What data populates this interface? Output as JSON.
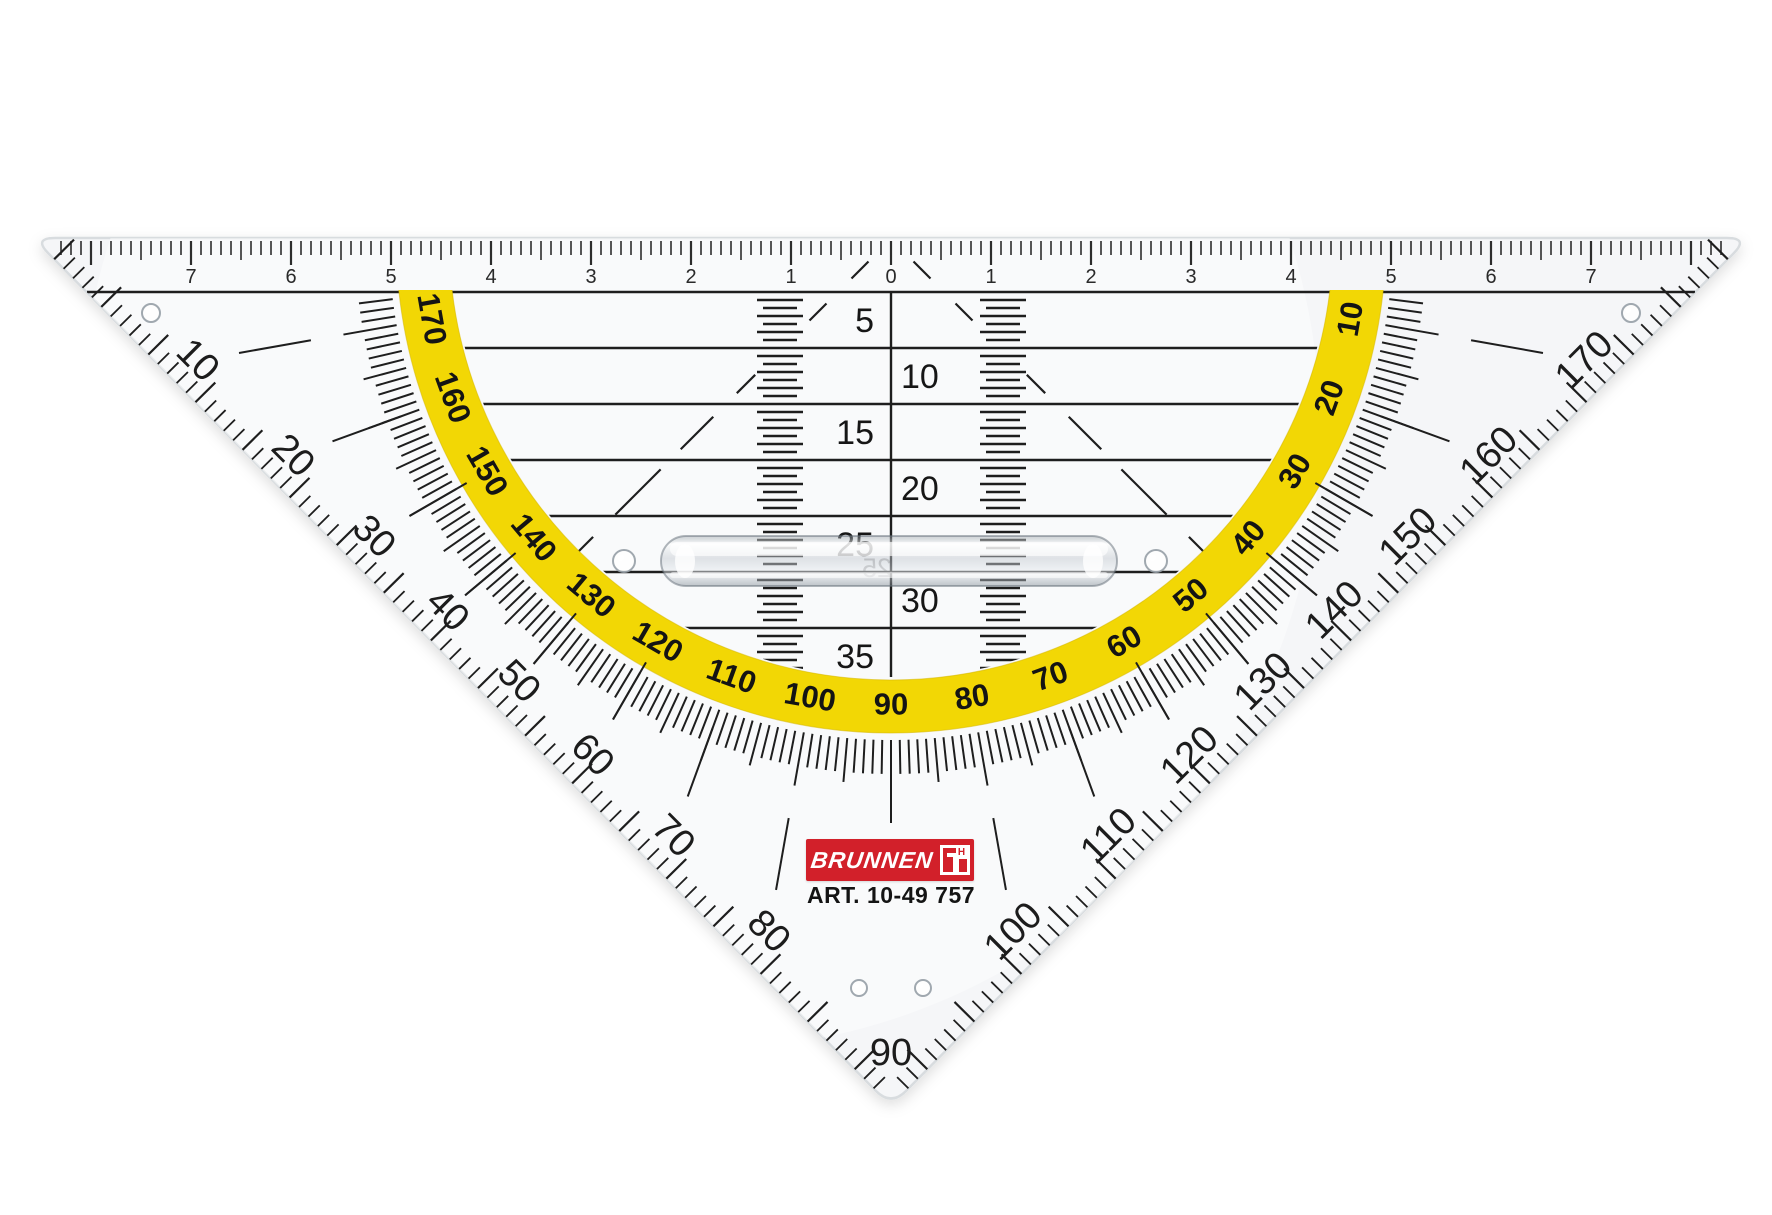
{
  "product": {
    "brand": "BRUNNEN",
    "art_number": "ART. 10-49 757",
    "logo_mark_letter": "H"
  },
  "colors": {
    "plastic": "#f5f6f8",
    "plastic_edge": "#d8dcdf",
    "ink": "#1e1e1e",
    "ink_soft": "#2d2d2d",
    "band_yellow": "#F2D705",
    "brand_red": "#d2202a",
    "white": "#ffffff"
  },
  "ruler": {
    "unit_labels": [
      "7",
      "6",
      "5",
      "4",
      "3",
      "2",
      "1",
      "0",
      "1",
      "2",
      "3",
      "4",
      "5",
      "6",
      "7"
    ]
  },
  "parallel_rows": {
    "labels": [
      "5",
      "10",
      "15",
      "20",
      "25",
      "30",
      "35"
    ],
    "occluded_label": "25"
  },
  "protractor": {
    "band_degrees": [
      "10",
      "20",
      "30",
      "40",
      "50",
      "60",
      "70",
      "80",
      "90",
      "100",
      "110",
      "120",
      "130",
      "140",
      "150",
      "160",
      "170"
    ],
    "outer_degrees": [
      "10",
      "20",
      "30",
      "40",
      "50",
      "60",
      "70",
      "80",
      "90",
      "100",
      "110",
      "120",
      "130",
      "140",
      "150",
      "160",
      "170"
    ]
  }
}
